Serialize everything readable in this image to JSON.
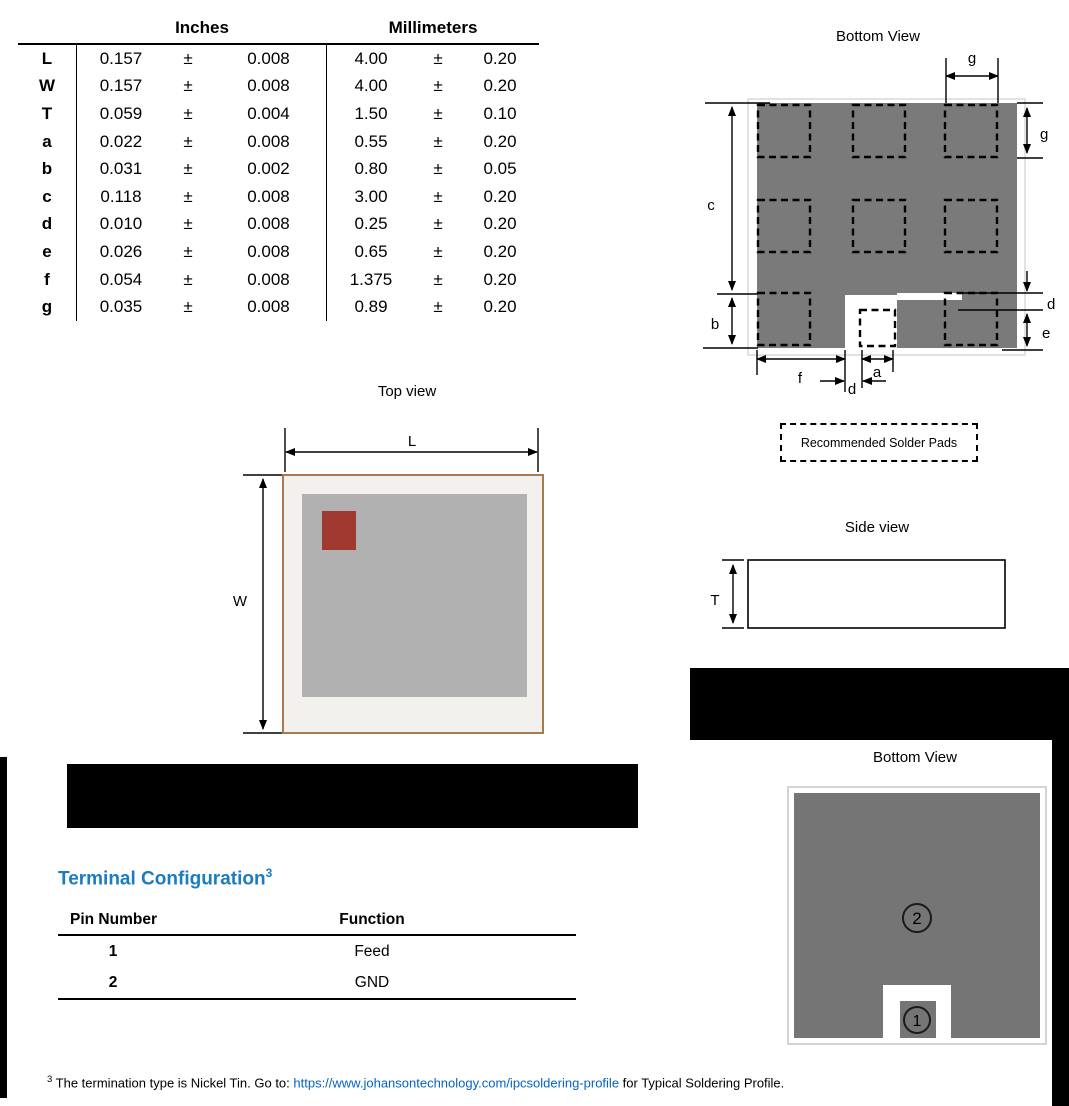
{
  "dimension_table": {
    "header_inches": "Inches",
    "header_millimeters": "Millimeters",
    "plus_minus": "±",
    "rows": [
      {
        "param": "L",
        "in_val": "0.157",
        "in_tol": "0.008",
        "mm_val": "4.00",
        "mm_tol": "0.20"
      },
      {
        "param": "W",
        "in_val": "0.157",
        "in_tol": "0.008",
        "mm_val": "4.00",
        "mm_tol": "0.20"
      },
      {
        "param": "T",
        "in_val": "0.059",
        "in_tol": "0.004",
        "mm_val": "1.50",
        "mm_tol": "0.10"
      },
      {
        "param": "a",
        "in_val": "0.022",
        "in_tol": "0.008",
        "mm_val": "0.55",
        "mm_tol": "0.20"
      },
      {
        "param": "b",
        "in_val": "0.031",
        "in_tol": "0.002",
        "mm_val": "0.80",
        "mm_tol": "0.05"
      },
      {
        "param": "c",
        "in_val": "0.118",
        "in_tol": "0.008",
        "mm_val": "3.00",
        "mm_tol": "0.20"
      },
      {
        "param": "d",
        "in_val": "0.010",
        "in_tol": "0.008",
        "mm_val": "0.25",
        "mm_tol": "0.20"
      },
      {
        "param": "e",
        "in_val": "0.026",
        "in_tol": "0.008",
        "mm_val": "0.65",
        "mm_tol": "0.20"
      },
      {
        "param": "f",
        "in_val": "0.054",
        "in_tol": "0.008",
        "mm_val": "1.375",
        "mm_tol": "0.20"
      },
      {
        "param": "g",
        "in_val": "0.035",
        "in_tol": "0.008",
        "mm_val": "0.89",
        "mm_tol": "0.20"
      }
    ]
  },
  "pads_view": {
    "title": "Bottom View",
    "labels": {
      "g_top": "g",
      "g_right": "g",
      "c": "c",
      "b": "b",
      "d_right": "d",
      "e": "e",
      "f": "f",
      "a": "a",
      "d_bottom": "d"
    }
  },
  "solder_note": "Recommended Solder Pads",
  "top_view": {
    "title": "Top view",
    "labels": {
      "L": "L",
      "W": "W"
    }
  },
  "side_view": {
    "title": "Side view",
    "labels": {
      "T": "T"
    }
  },
  "pins_view": {
    "title": "Bottom View",
    "pin1": "1",
    "pin2": "2"
  },
  "terminal_configuration": {
    "heading": "Terminal Configuration",
    "heading_sup": "3",
    "col_pin": "Pin Number",
    "col_function": "Function",
    "rows": [
      {
        "pin": "1",
        "fn": "Feed"
      },
      {
        "pin": "2",
        "fn": "GND"
      }
    ]
  },
  "footnote": {
    "sup": "3",
    "before_link": " The termination type is Nickel Tin. Go to: ",
    "link": "https://www.johansontechnology.com/ipcsoldering-profile",
    "after_link": " for Typical Soldering Profile."
  },
  "colors": {
    "heading_blue": "#1b7cc1",
    "link_blue": "#0563c1",
    "chip_gray": "#7a7a7a",
    "pins_gray": "#757575",
    "top_view_fill": "#f3f1ee",
    "top_view_border": "#a87a50",
    "top_view_inner_gray": "#b1b1b1",
    "top_view_red": "#a0392f",
    "redaction_black": "#000000"
  }
}
